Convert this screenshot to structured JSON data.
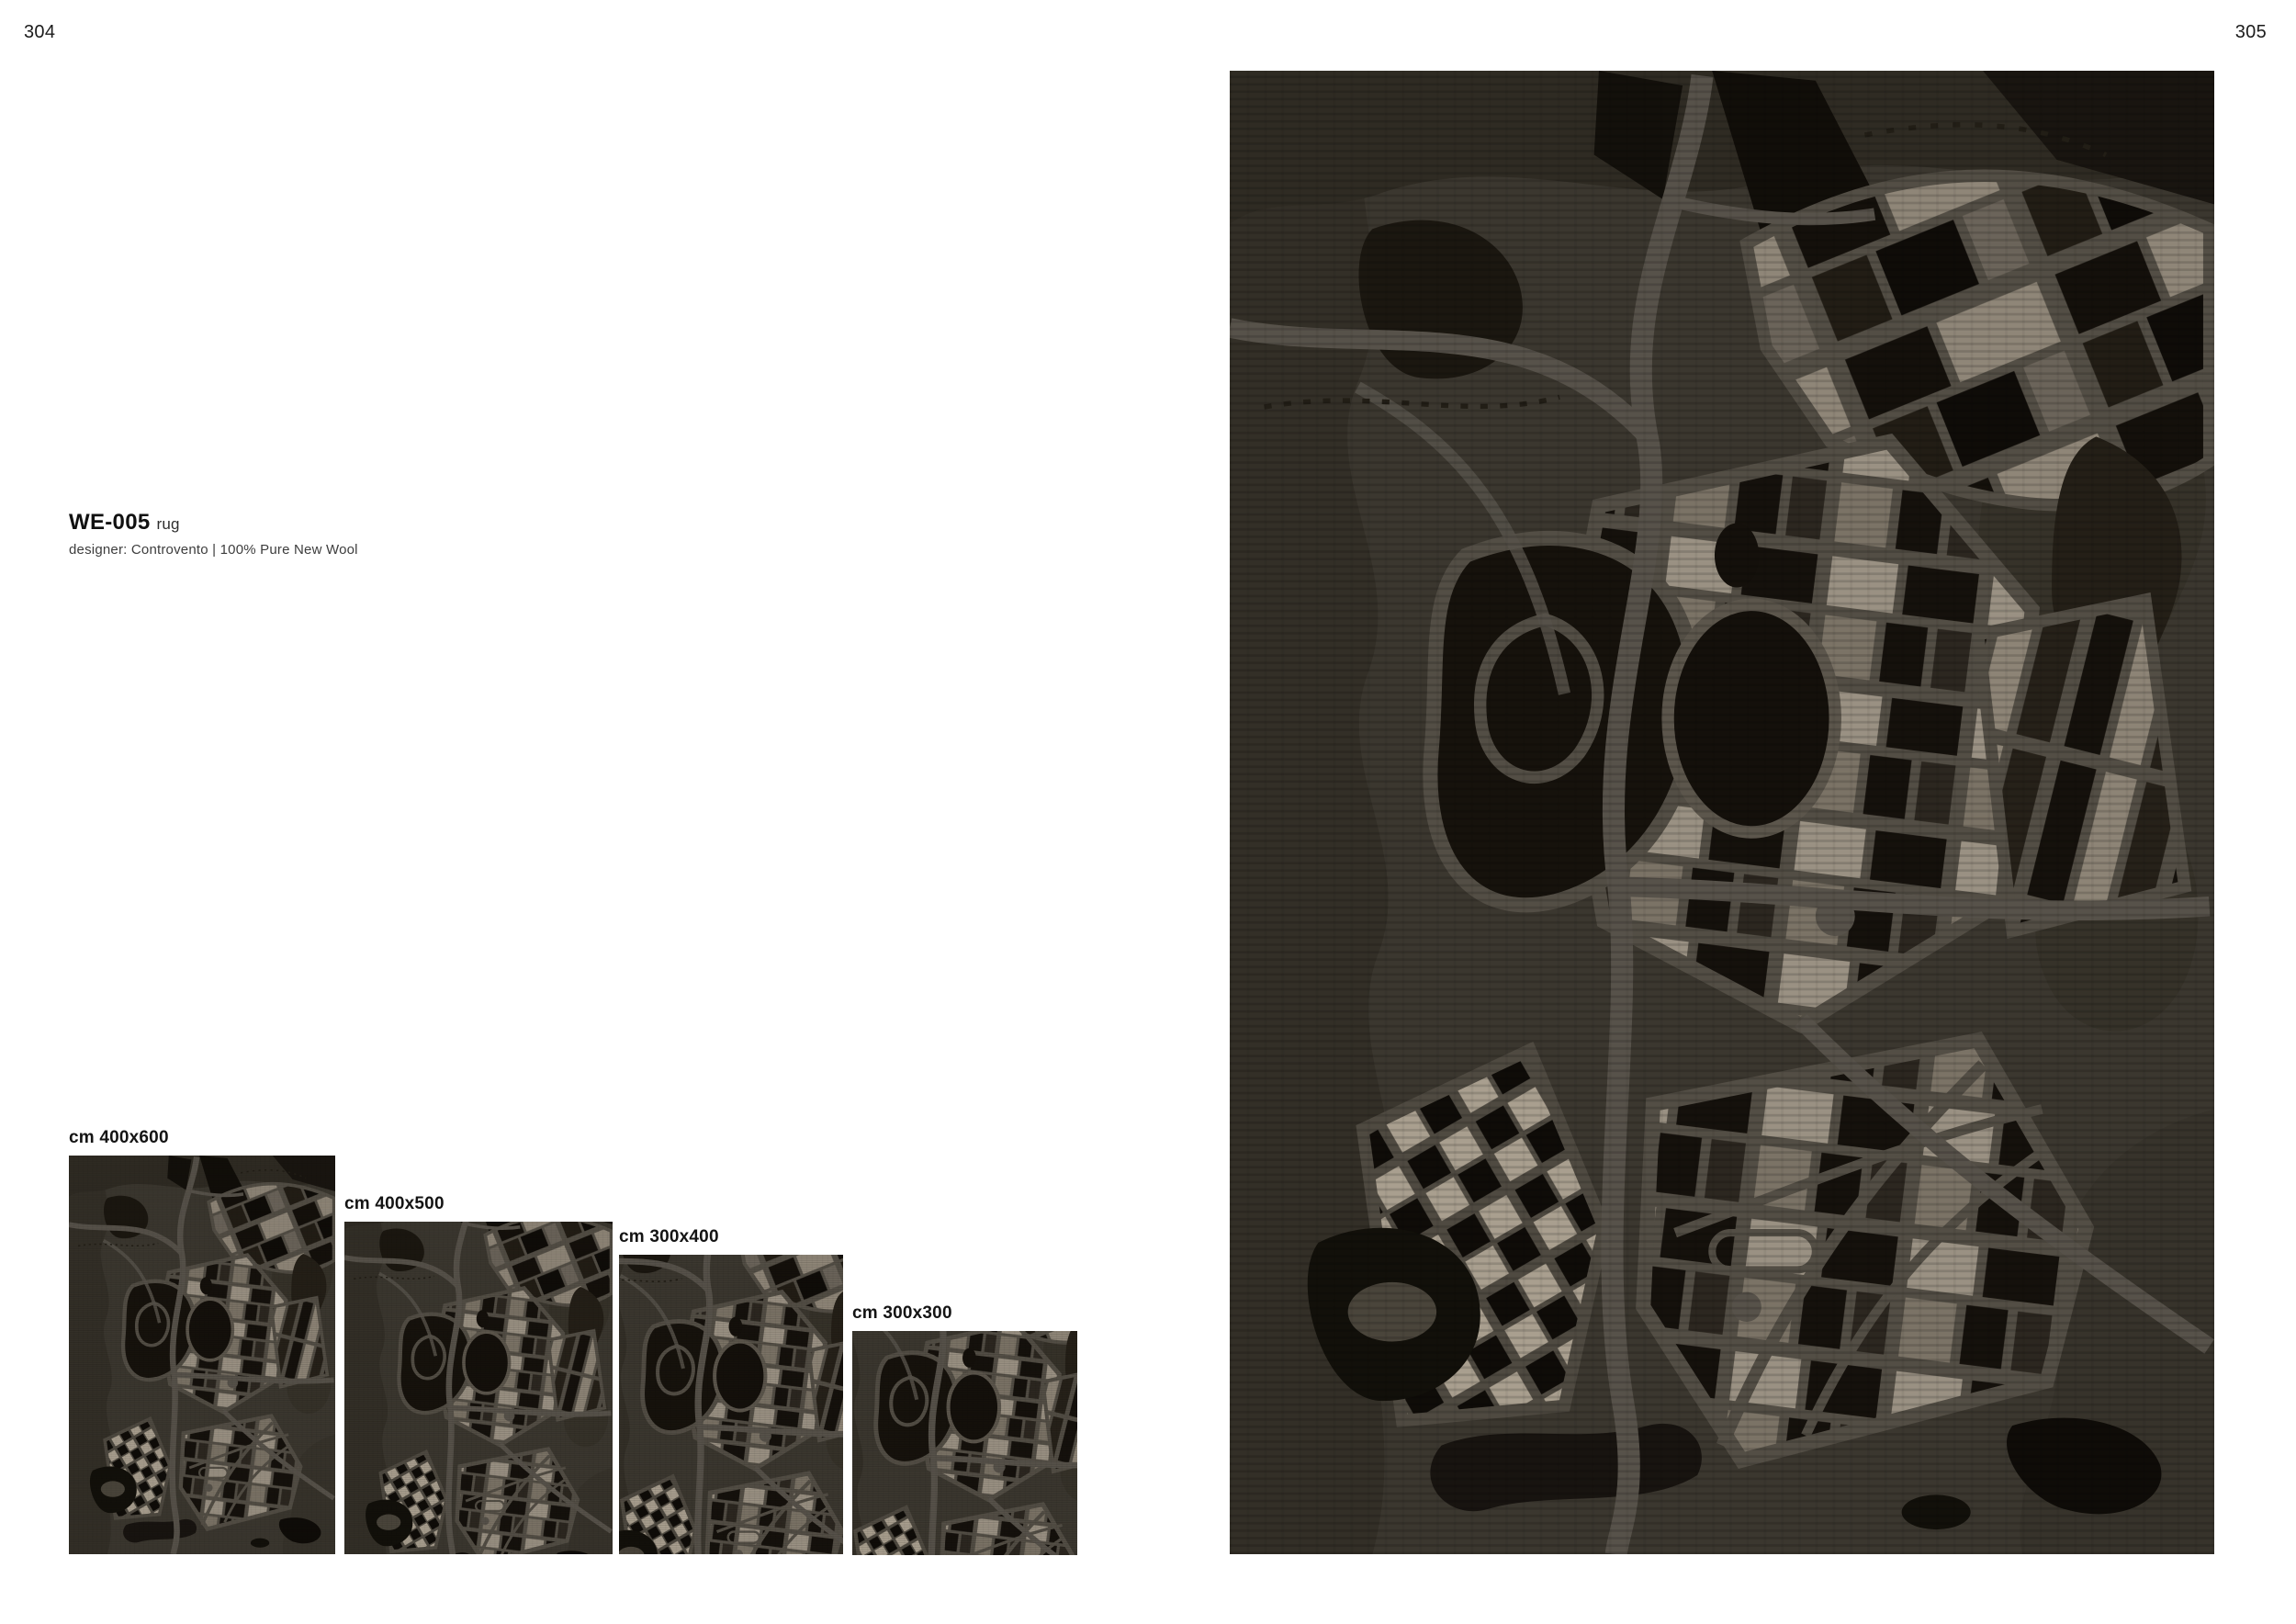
{
  "page": {
    "left_number": "304",
    "right_number": "305"
  },
  "product": {
    "code": "WE-005",
    "type": "rug",
    "details": "designer: Controvento | 100% Pure New Wool"
  },
  "sizes": [
    {
      "label": "cm 400x600",
      "width_cm": 400,
      "height_cm": 600
    },
    {
      "label": "cm 400x500",
      "width_cm": 400,
      "height_cm": 500
    },
    {
      "label": "cm 300x400",
      "width_cm": 300,
      "height_cm": 400
    },
    {
      "label": "cm 300x300",
      "width_cm": 300,
      "height_cm": 300
    }
  ],
  "rug_palette": {
    "background": "#3b372f",
    "roads": "#57524a",
    "black_blocks": "#14100b",
    "beige_blocks": "#958c7d",
    "dark_olive": "#2f2b23"
  }
}
